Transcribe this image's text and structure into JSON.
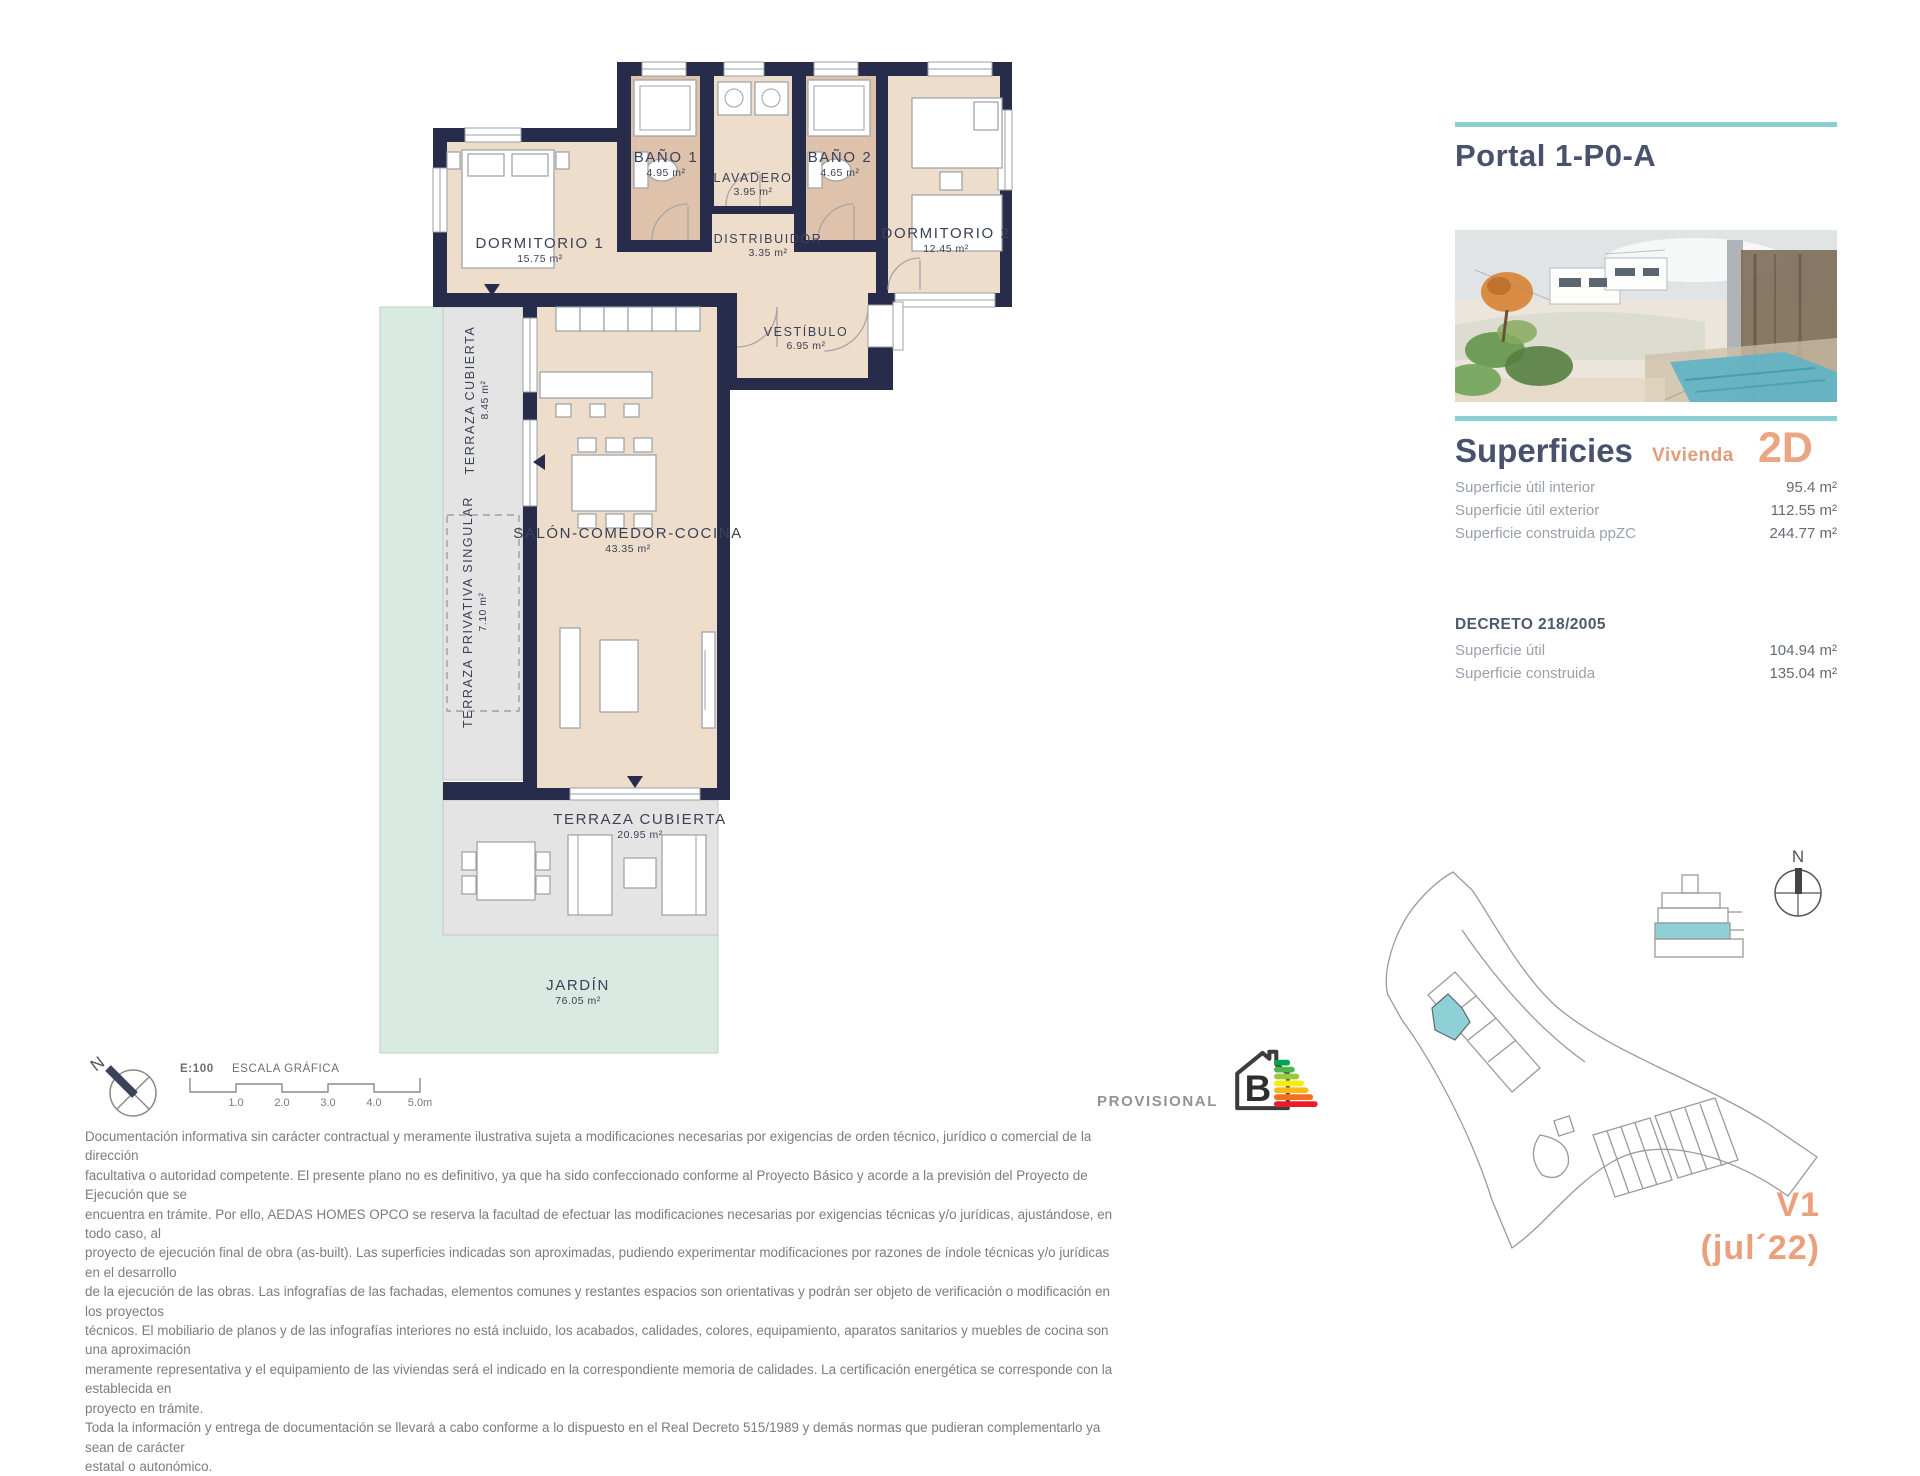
{
  "panel": {
    "title": "Portal 1-P0-A",
    "superficies_title": "Superficies",
    "vivienda_label": "Vivienda",
    "vivienda_type": "2D",
    "rows": [
      {
        "label": "Superficie útil interior",
        "value": "95.4 m²"
      },
      {
        "label": "Superficie útil exterior",
        "value": "112.55 m²"
      },
      {
        "label": "Superficie construida ppZC",
        "value": "244.77 m²"
      }
    ],
    "decreto_title": "DECRETO 218/2005",
    "decreto_rows": [
      {
        "label": "Superficie útil",
        "value": "104.94 m²"
      },
      {
        "label": "Superficie construida",
        "value": "135.04 m²"
      }
    ],
    "version_line1": "V1",
    "version_line2": "(jul´22)"
  },
  "plan": {
    "rooms": [
      {
        "name": "DORMITORIO 1",
        "area": "15.75 m²"
      },
      {
        "name": "BAÑO 1",
        "area": "4.95 m²"
      },
      {
        "name": "LAVADERO",
        "area": "3.95 m²"
      },
      {
        "name": "BAÑO 2",
        "area": "4.65 m²"
      },
      {
        "name": "DORMITORIO 2",
        "area": "12.45 m²"
      },
      {
        "name": "DISTRIBUIDOR",
        "area": "3.35 m²"
      },
      {
        "name": "VESTÍBULO",
        "area": "6.95 m²"
      },
      {
        "name": "SALÓN-COMEDOR-COCINA",
        "area": "43.35 m²"
      },
      {
        "name": "TERRAZA CUBIERTA",
        "area": "8.45 m²"
      },
      {
        "name": "TERRAZA PRIVATIVA SINGULAR",
        "area": "7.10 m²"
      },
      {
        "name": "TERRAZA CUBIERTA",
        "area": "20.95 m²"
      },
      {
        "name": "JARDÍN",
        "area": "76.05 m²"
      }
    ]
  },
  "scale": {
    "ratio": "E:100",
    "title": "ESCALA GRÁFICA",
    "ticks": [
      "1.0",
      "2.0",
      "3.0",
      "4.0",
      "5.0m"
    ]
  },
  "energy": {
    "label": "PROVISIONAL",
    "rating": "B"
  },
  "compass": {
    "north_label": "N"
  },
  "site": {
    "north_label": "N"
  },
  "colors": {
    "wall_navy": "#272c4b",
    "floor_beige": "#eeddca",
    "bath_tan": "#dfc2ab",
    "terrace_gray": "#e4e4e4",
    "garden_mint": "#d8eae1",
    "accent_teal": "#8bced3",
    "accent_salmon": "#eaa583",
    "heading_navy": "#49526d"
  },
  "legal": {
    "text": "Documentación informativa sin carácter contractual y meramente ilustrativa sujeta a modificaciones necesarias por exigencias de orden técnico, jurídico o comercial de la dirección\nfacultativa o autoridad competente. El presente plano no es definitivo, ya que ha sido confeccionado conforme al Proyecto Básico y acorde a la previsión del Proyecto de Ejecución que se\nencuentra en trámite. Por ello, AEDAS HOMES OPCO se reserva la facultad de efectuar las modificaciones necesarias por exigencias técnicas y/o jurídicas, ajustándose, en todo caso, al\nproyecto de ejecución final de obra (as-built). Las superficies indicadas son aproximadas, pudiendo experimentar modificaciones por razones de índole técnicas y/o jurídicas en el desarrollo\nde la ejecución de las obras. Las infografías de las fachadas, elementos comunes y restantes espacios son orientativas y podrán ser objeto de verificación o modificación en los proyectos\ntécnicos. El mobiliario de planos y de las infografías interiores no está incluido, los acabados, calidades, colores, equipamiento, aparatos sanitarios y muebles de cocina son una aproximación\nmeramente representativa y el equipamiento de las viviendas será el indicado en la correspondiente memoria de calidades. La certificación energética se corresponde con la establecida en\nproyecto en trámite.\nToda la información y entrega de documentación se llevará a cabo conforme a lo dispuesto en el Real Decreto 515/1989 y demás normas que pudieran complementarlo ya sean de carácter\nestatal o autonómico."
  }
}
